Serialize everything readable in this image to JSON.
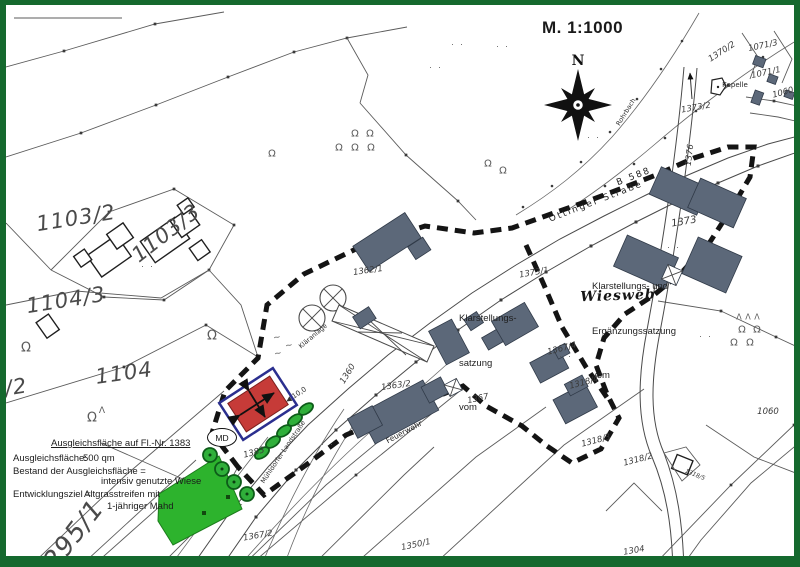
{
  "scale": {
    "label": "M. 1:1000"
  },
  "compass": {
    "n": "N"
  },
  "road_sign": "MD",
  "annotations": {
    "left": [
      "Klarstellungs-",
      "satzung",
      "vom"
    ],
    "right": [
      "Klarstellungs- und",
      "Ergänzungssatzung",
      "vom"
    ]
  },
  "legend": {
    "title": "Ausgleichsfläche auf Fl.-Nr. 1383",
    "l1a": "Ausgleichsfläche:",
    "l1b": "500 qm",
    "l2a": "Bestand der Ausgleichsfläche =",
    "l2b": "intensiv genutzte Wiese",
    "l3a": "Entwicklungsziel =",
    "l3b": "Altgrasstreifen mit",
    "l3c": "1-jähriger Mahd"
  },
  "colors": {
    "frame": "#15692e",
    "building": "#5c6879",
    "red": "#c63b38",
    "blue": "#2b2f8f",
    "green_area": "#2db32d",
    "tree": "#2faf3a",
    "boundary": "#141414",
    "line": "#4a4a4a"
  },
  "labels": [
    {
      "t": "1103/2",
      "x": 70,
      "y": 213,
      "r": -9,
      "c": "big"
    },
    {
      "t": "1103/3",
      "x": 160,
      "y": 228,
      "r": -38,
      "c": "big"
    },
    {
      "t": "1104/3",
      "x": 60,
      "y": 295,
      "r": -9,
      "c": "big"
    },
    {
      "t": "1104",
      "x": 118,
      "y": 368,
      "r": -8,
      "c": "big"
    },
    {
      "t": "/2",
      "x": 10,
      "y": 382,
      "r": -9,
      "c": "big"
    },
    {
      "t": "295/1",
      "x": 68,
      "y": 530,
      "r": -52,
      "c": "big",
      "fs": 26
    },
    {
      "t": "1362/1",
      "x": 362,
      "y": 266,
      "r": -8,
      "c": "num"
    },
    {
      "t": "1360",
      "x": 342,
      "y": 369,
      "r": -58,
      "c": "num"
    },
    {
      "t": "1363/2",
      "x": 390,
      "y": 381,
      "r": -8,
      "c": "num"
    },
    {
      "t": "1367",
      "x": 472,
      "y": 394,
      "r": -12,
      "c": "num"
    },
    {
      "t": "1373/1",
      "x": 528,
      "y": 268,
      "r": -10,
      "c": "num"
    },
    {
      "t": "1373",
      "x": 678,
      "y": 217,
      "r": -10,
      "c": "num",
      "fs": 10
    },
    {
      "t": "1367/4",
      "x": 556,
      "y": 344,
      "r": -15,
      "c": "num"
    },
    {
      "t": "1318/4",
      "x": 578,
      "y": 378,
      "r": -15,
      "c": "num"
    },
    {
      "t": "1318/3",
      "x": 590,
      "y": 436,
      "r": -15,
      "c": "num"
    },
    {
      "t": "1318/2",
      "x": 632,
      "y": 455,
      "r": -15,
      "c": "num"
    },
    {
      "t": "1318/5",
      "x": 689,
      "y": 470,
      "r": 22,
      "c": "num",
      "fs": 6
    },
    {
      "t": "1304",
      "x": 628,
      "y": 546,
      "r": -10,
      "c": "num"
    },
    {
      "t": "1350/1",
      "x": 410,
      "y": 540,
      "r": -12,
      "c": "num"
    },
    {
      "t": "1367/2",
      "x": 252,
      "y": 531,
      "r": -10,
      "c": "num"
    },
    {
      "t": "1373/2",
      "x": 690,
      "y": 103,
      "r": -10,
      "c": "num"
    },
    {
      "t": "1370/2",
      "x": 716,
      "y": 47,
      "r": -33,
      "c": "num"
    },
    {
      "t": "1071/3",
      "x": 757,
      "y": 41,
      "r": -12,
      "c": "num"
    },
    {
      "t": "1071/1",
      "x": 760,
      "y": 68,
      "r": -12,
      "c": "num"
    },
    {
      "t": "1060",
      "x": 777,
      "y": 88,
      "r": -15,
      "c": "num"
    },
    {
      "t": "1060",
      "x": 762,
      "y": 407,
      "r": 0,
      "c": "num"
    },
    {
      "t": "1376",
      "x": 684,
      "y": 150,
      "r": -83,
      "c": "num"
    },
    {
      "t": "1383",
      "x": 248,
      "y": 448,
      "r": -15,
      "c": "num"
    },
    {
      "t": "Feuerwehr",
      "x": 398,
      "y": 427,
      "r": -28,
      "c": "name"
    },
    {
      "t": "Kapelle",
      "x": 729,
      "y": 80,
      "r": 0,
      "c": "name",
      "fs": 7
    },
    {
      "t": "Kläranlage",
      "x": 307,
      "y": 331,
      "r": -40,
      "c": "tiny"
    },
    {
      "t": "Wiesweb",
      "x": 612,
      "y": 291,
      "r": -2,
      "c": "wies"
    },
    {
      "t": "Ottinger Straße",
      "x": 590,
      "y": 197,
      "r": -21,
      "c": "street"
    },
    {
      "t": "B 588",
      "x": 628,
      "y": 172,
      "r": -21,
      "c": "street"
    },
    {
      "t": "Rohrbach",
      "x": 620,
      "y": 107,
      "r": -58,
      "c": "tiny"
    },
    {
      "t": "Mühldorfer Landstraße",
      "x": 277,
      "y": 447,
      "r": -56,
      "c": "tiny"
    },
    {
      "t": "◀ 10,0",
      "x": 290,
      "y": 390,
      "r": -33,
      "c": "tiny",
      "fs": 7
    },
    {
      "t": "Ω",
      "x": 349,
      "y": 129,
      "r": 0,
      "c": "om"
    },
    {
      "t": "Ω",
      "x": 364,
      "y": 129,
      "r": 0,
      "c": "om"
    },
    {
      "t": "Ω",
      "x": 333,
      "y": 143,
      "r": 0,
      "c": "om"
    },
    {
      "t": "Ω",
      "x": 349,
      "y": 143,
      "r": 0,
      "c": "om"
    },
    {
      "t": "Ω",
      "x": 365,
      "y": 143,
      "r": 0,
      "c": "om"
    },
    {
      "t": "Ω",
      "x": 266,
      "y": 149,
      "r": 0,
      "c": "om"
    },
    {
      "t": "Ω",
      "x": 206,
      "y": 331,
      "r": 0,
      "c": "om",
      "fs": 13
    },
    {
      "t": "Ω",
      "x": 86,
      "y": 413,
      "r": 0,
      "c": "om",
      "fs": 13
    },
    {
      "t": "Ω",
      "x": 20,
      "y": 343,
      "r": 0,
      "c": "om",
      "fs": 13
    },
    {
      "t": "Ω",
      "x": 736,
      "y": 325,
      "r": 0,
      "c": "om"
    },
    {
      "t": "Ω",
      "x": 751,
      "y": 325,
      "r": 0,
      "c": "om"
    },
    {
      "t": "Ω",
      "x": 728,
      "y": 338,
      "r": 0,
      "c": "om"
    },
    {
      "t": "Ω",
      "x": 744,
      "y": 338,
      "r": 0,
      "c": "om"
    },
    {
      "t": "Ω",
      "x": 482,
      "y": 159,
      "r": 0,
      "c": "om"
    },
    {
      "t": "Ω",
      "x": 497,
      "y": 166,
      "r": 0,
      "c": "om"
    },
    {
      "t": "Λ",
      "x": 733,
      "y": 312,
      "r": 0,
      "c": "om",
      "fs": 8
    },
    {
      "t": "Λ",
      "x": 742,
      "y": 312,
      "r": 0,
      "c": "om",
      "fs": 8
    },
    {
      "t": "Λ",
      "x": 751,
      "y": 312,
      "r": 0,
      "c": "om",
      "fs": 8
    },
    {
      "t": "Λ",
      "x": 96,
      "y": 406,
      "r": 0,
      "c": "om",
      "fs": 9
    },
    {
      "t": "· ·",
      "x": 452,
      "y": 40,
      "r": 0,
      "c": "dots"
    },
    {
      "t": "· ·",
      "x": 497,
      "y": 42,
      "r": 0,
      "c": "dots"
    },
    {
      "t": "· ·",
      "x": 430,
      "y": 63,
      "r": 0,
      "c": "dots"
    },
    {
      "t": "· ·",
      "x": 588,
      "y": 133,
      "r": 0,
      "c": "dots"
    },
    {
      "t": "· ·",
      "x": 668,
      "y": 243,
      "r": 0,
      "c": "dots"
    },
    {
      "t": "· ·",
      "x": 322,
      "y": 440,
      "r": 0,
      "c": "dots"
    },
    {
      "t": "· ·",
      "x": 142,
      "y": 262,
      "r": 0,
      "c": "dots"
    },
    {
      "t": "· ·",
      "x": 700,
      "y": 332,
      "r": 0,
      "c": "dots"
    },
    {
      "t": "· ·",
      "x": 560,
      "y": 352,
      "r": 0,
      "c": "dots"
    },
    {
      "t": "∼",
      "x": 271,
      "y": 333,
      "r": -10,
      "c": "om",
      "fs": 9
    },
    {
      "t": "∼",
      "x": 283,
      "y": 341,
      "r": -10,
      "c": "om",
      "fs": 9
    },
    {
      "t": "∼",
      "x": 272,
      "y": 349,
      "r": -10,
      "c": "om",
      "fs": 9
    }
  ]
}
